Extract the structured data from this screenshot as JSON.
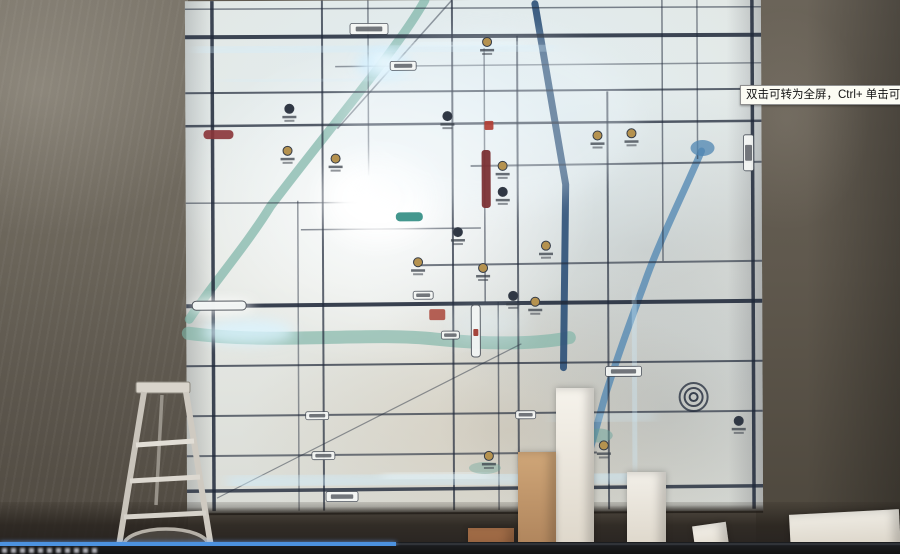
{
  "tooltip": {
    "text": "双击可转为全屏，Ctrl+ 单击可转为全屏",
    "bg": "#fcfcf4",
    "border": "#8f8f8f"
  },
  "player": {
    "progress_fraction": 0.44,
    "progress_color": "#4c92e0",
    "track_color": "#3a3e44",
    "bar_color": "#141414"
  },
  "palette": {
    "wall_brown_grey": "#6b655a",
    "map_white": "#e7eae6",
    "led_cyan": "#cfeeff",
    "road_dark": "#20293a",
    "river_teal": "#7cb4a6",
    "river_blue": "#4f85b2",
    "expressway_blue": "#30527a",
    "accent_maroon": "#7b3034",
    "accent_red": "#a63c30",
    "logo_gold": "#b5924f"
  },
  "scene": {
    "map": {
      "road_color": "#20293a",
      "roads": [
        [
          0,
          8,
          576,
          8,
          1.5,
          0.55
        ],
        [
          0,
          36,
          576,
          36,
          4,
          0.85
        ],
        [
          150,
          66,
          576,
          64,
          1.5,
          0.45
        ],
        [
          0,
          92,
          576,
          90,
          2,
          0.7
        ],
        [
          0,
          125,
          576,
          122,
          2.5,
          0.75
        ],
        [
          285,
          166,
          576,
          163,
          2,
          0.6
        ],
        [
          0,
          202,
          175,
          202,
          1.5,
          0.5
        ],
        [
          115,
          229,
          295,
          228,
          1.5,
          0.5
        ],
        [
          235,
          265,
          576,
          262,
          2,
          0.6
        ],
        [
          0,
          305,
          576,
          302,
          4,
          0.88
        ],
        [
          0,
          365,
          576,
          362,
          2,
          0.7
        ],
        [
          0,
          415,
          576,
          412,
          2,
          0.65
        ],
        [
          0,
          455,
          410,
          453,
          2,
          0.6
        ],
        [
          0,
          490,
          576,
          487,
          3.5,
          0.8
        ],
        [
          27,
          0,
          27,
          510,
          3.5,
          0.85
        ],
        [
          112,
          200,
          112,
          510,
          1.5,
          0.45
        ],
        [
          137,
          0,
          137,
          510,
          2,
          0.7
        ],
        [
          183,
          0,
          183,
          175,
          1.5,
          0.5
        ],
        [
          267,
          0,
          267,
          510,
          2,
          0.7
        ],
        [
          299,
          48,
          299,
          302,
          1.5,
          0.55
        ],
        [
          312,
          302,
          312,
          510,
          1.5,
          0.55
        ],
        [
          332,
          36,
          332,
          510,
          2,
          0.65
        ],
        [
          422,
          92,
          422,
          510,
          2,
          0.65
        ],
        [
          477,
          0,
          477,
          262,
          1.5,
          0.55
        ],
        [
          512,
          0,
          512,
          160,
          1.5,
          0.5
        ],
        [
          567,
          0,
          567,
          510,
          3.5,
          0.85
        ],
        [
          267,
          0,
          152,
          128,
          1.5,
          0.45
        ],
        [
          30,
          497,
          335,
          344,
          1.2,
          0.45
        ]
      ],
      "bands": [
        [
          "M240,0 C215,45 150,120 85,205 C60,245 25,285 3,318",
          "#7cb4a6",
          9,
          0.7
        ],
        [
          "M2,332 C90,344 180,331 250,339 C305,345 355,344 383,338",
          "#7cb4a6",
          13,
          0.65
        ],
        [
          "M516,152 C495,200 472,245 458,285 C444,322 430,360 418,398 C410,428 402,452 397,474",
          "#4f85b2",
          7,
          0.75
        ],
        [
          "M350,4 L380,185 L377,368",
          "#30527a",
          7,
          0.92
        ]
      ],
      "glows": [
        {
          "k": "e",
          "v": [
            192,
            198,
            54,
            42,
            "#ffffff",
            0.95,
            "b12"
          ]
        },
        {
          "k": "e",
          "v": [
            188,
            196,
            28,
            22,
            "#ffffff",
            1,
            "b6"
          ]
        },
        {
          "k": "e",
          "v": [
            198,
            64,
            26,
            15,
            "#cdeeff",
            0.85,
            "b6"
          ]
        },
        {
          "k": "e",
          "v": [
            199,
            62,
            12,
            8,
            "#f0fbff",
            0.9,
            "b6"
          ]
        },
        {
          "k": "l",
          "v": [
            15,
            50,
            365,
            47,
            9,
            "#cfeeff",
            0.55,
            "b6"
          ]
        },
        {
          "k": "l",
          "v": [
            230,
            45,
            330,
            43,
            10,
            "#e8f8ff",
            0.6,
            "b6"
          ]
        },
        {
          "k": "l",
          "v": [
            40,
            80,
            230,
            79,
            6,
            "#cfeeff",
            0.4,
            "b6"
          ]
        },
        {
          "k": "l",
          "v": [
            38,
            60,
            38,
            210,
            7,
            "#cfeeff",
            0.5,
            "b6"
          ]
        },
        {
          "k": "e",
          "v": [
            62,
            331,
            46,
            13,
            "#dbf4ff",
            0.8,
            "b6"
          ]
        },
        {
          "k": "l",
          "v": [
            45,
            482,
            445,
            477,
            12,
            "#cfeeff",
            0.65,
            "b6"
          ]
        },
        {
          "k": "l",
          "v": [
            200,
            477,
            300,
            474,
            11,
            "#eefaff",
            0.55,
            "b6"
          ]
        },
        {
          "k": "l",
          "v": [
            447,
            298,
            449,
            466,
            9,
            "#cfeeff",
            0.6,
            "b6"
          ]
        },
        {
          "k": "l",
          "v": [
            370,
            420,
            465,
            416,
            8,
            "#cfeeff",
            0.45,
            "b6"
          ]
        },
        {
          "k": "e",
          "v": [
            302,
            326,
            40,
            12,
            "#dff2fb",
            0.5,
            "b12"
          ]
        },
        {
          "k": "e",
          "v": [
            35,
            305,
            32,
            7,
            "#ffffff",
            0.85,
            "b6"
          ]
        },
        {
          "k": "e",
          "v": [
            300,
            120,
            150,
            90,
            "#eef6fa",
            0.3,
            "b12"
          ]
        }
      ],
      "accents": [
        [
          "r",
          296,
          150,
          9,
          58,
          "#7b3034",
          0.95,
          3,
          ""
        ],
        [
          "r",
          18,
          129,
          30,
          9,
          "#8a3438",
          0.9,
          4,
          ""
        ],
        [
          "r",
          6,
          300,
          54,
          9,
          "#f4f7f6",
          0.97,
          4,
          "#50555c"
        ],
        [
          "r",
          210,
          212,
          27,
          9,
          "#2f8c82",
          0.9,
          4,
          ""
        ],
        [
          "r",
          243,
          309,
          16,
          11,
          "#a63c30",
          0.8,
          2,
          ""
        ],
        [
          "r",
          299,
          121,
          9,
          9,
          "#b03a30",
          0.9,
          1.5,
          ""
        ],
        [
          "r",
          285,
          305,
          9,
          52,
          "#f2f5f4",
          0.95,
          3,
          "#555b63"
        ],
        [
          "r",
          287,
          329,
          5,
          7,
          "#a03b32",
          0.95,
          1,
          ""
        ],
        [
          "c",
          507,
          398,
          4,
          "#20293a",
          2,
          0.85
        ],
        [
          "c",
          507,
          398,
          9,
          "#20293a",
          2,
          0.8
        ],
        [
          "c",
          507,
          398,
          14,
          "#20293a",
          2,
          0.75
        ],
        [
          "el",
          517,
          149,
          12,
          8,
          "#4f85b2",
          0.75
        ],
        [
          "el",
          412,
          436,
          14,
          7,
          "#6aa49b",
          0.5
        ],
        [
          "el",
          298,
          468,
          16,
          6,
          "#6aa49b",
          0.4
        ]
      ],
      "pills": [
        [
          165,
          23,
          38,
          11
        ],
        [
          205,
          61,
          26,
          9
        ],
        [
          558,
          136,
          10,
          36
        ],
        [
          119,
          411,
          23,
          8
        ],
        [
          125,
          451,
          23,
          8
        ],
        [
          139,
          491,
          32,
          10
        ],
        [
          419,
          367,
          36,
          10
        ],
        [
          227,
          291,
          20,
          8
        ],
        [
          255,
          331,
          18,
          8
        ],
        [
          329,
          411,
          20,
          8
        ]
      ],
      "logos": [
        [
          104,
          108
        ],
        [
          102,
          150
        ],
        [
          150,
          158
        ],
        [
          262,
          116
        ],
        [
          302,
          42
        ],
        [
          317,
          166
        ],
        [
          317,
          192
        ],
        [
          412,
          136
        ],
        [
          446,
          134
        ],
        [
          272,
          232
        ],
        [
          232,
          262
        ],
        [
          297,
          268
        ],
        [
          327,
          296
        ],
        [
          349,
          302
        ],
        [
          417,
          446
        ],
        [
          552,
          422
        ],
        [
          302,
          456
        ],
        [
          360,
          246
        ]
      ]
    },
    "foam_blocks": [
      {
        "left": 556,
        "top": 388,
        "w": 38,
        "h": 166,
        "c1": "#f6f3ec",
        "c2": "#ddd6c9",
        "rot": 0
      },
      {
        "left": 518,
        "top": 452,
        "w": 38,
        "h": 102,
        "c1": "#cfa678",
        "c2": "#ad825a",
        "rot": 0
      },
      {
        "left": 627,
        "top": 472,
        "w": 39,
        "h": 82,
        "c1": "#f2efe8",
        "c2": "#dcd5c8",
        "rot": 0
      },
      {
        "left": 694,
        "top": 524,
        "w": 34,
        "h": 30,
        "c1": "#f3f0e9",
        "c2": "#ded7ca",
        "rot": -8
      },
      {
        "left": 790,
        "top": 512,
        "w": 110,
        "h": 42,
        "c1": "#efece4",
        "c2": "#d8d1c4",
        "rot": -3
      },
      {
        "left": 468,
        "top": 528,
        "w": 46,
        "h": 26,
        "c1": "#a8714a",
        "c2": "#8a5a3a",
        "rot": 0
      }
    ]
  }
}
